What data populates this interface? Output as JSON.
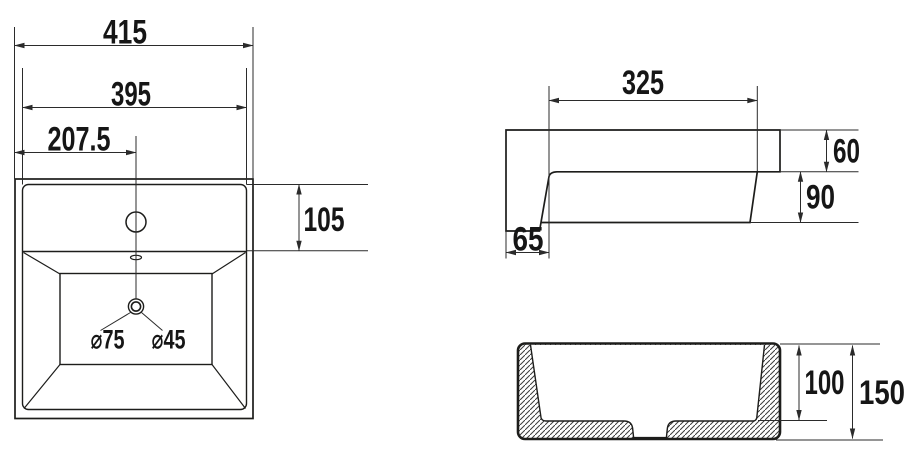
{
  "title": "Washbasin technical drawing",
  "colors": {
    "background": "#ffffff",
    "line": "#1d1d1b",
    "dim_line": "#2b2b2b",
    "text": "#161616"
  },
  "views": {
    "top": {
      "name": "top view",
      "labels": {
        "overall_width": "415",
        "inner_width": "395",
        "center_offset": "207.5",
        "deck_depth": "105",
        "hole_left": "⌀75",
        "hole_right": "⌀45"
      }
    },
    "side": {
      "name": "side view",
      "labels": {
        "bowl_length": "325",
        "rim_height": "60",
        "bowl_height": "90",
        "back_offset": "65"
      }
    },
    "section": {
      "name": "front section view",
      "labels": {
        "inner_depth": "100",
        "overall_height": "150"
      }
    }
  }
}
